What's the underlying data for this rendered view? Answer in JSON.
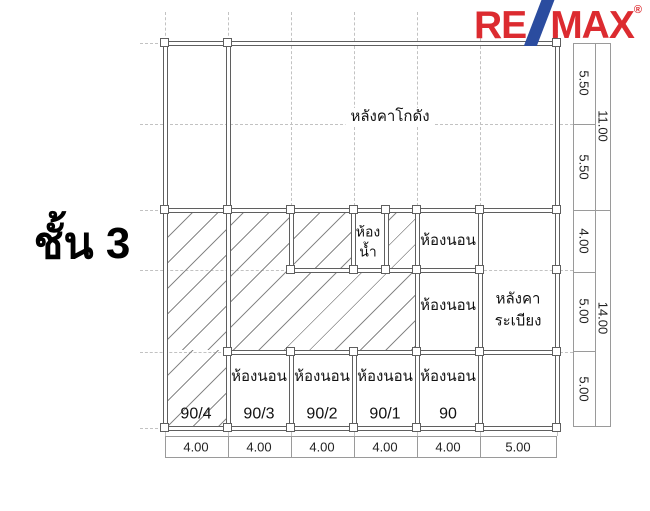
{
  "page": {
    "floor_label": "ชั้น 3"
  },
  "logo": {
    "re": "RE",
    "max": "MAX",
    "registered": "®",
    "red": "#dc2b30",
    "blue": "#2b4c9f"
  },
  "rooms": {
    "warehouse_roof": "หลังคาโกดัง",
    "bathroom": "ห้อง\nน้ำ",
    "bedroom": "ห้องนอน",
    "balcony_roof": "หลังคา\nระเบียง",
    "units": [
      "90/4",
      "90/3",
      "90/2",
      "90/1",
      "90"
    ]
  },
  "dimensions": {
    "right_inner": [
      "5.50",
      "5.50",
      "4.00",
      "5.00",
      "5.00"
    ],
    "right_outer": [
      "11.00",
      "14.00"
    ],
    "bottom": [
      "4.00",
      "4.00",
      "4.00",
      "4.00",
      "4.00",
      "5.00"
    ]
  }
}
